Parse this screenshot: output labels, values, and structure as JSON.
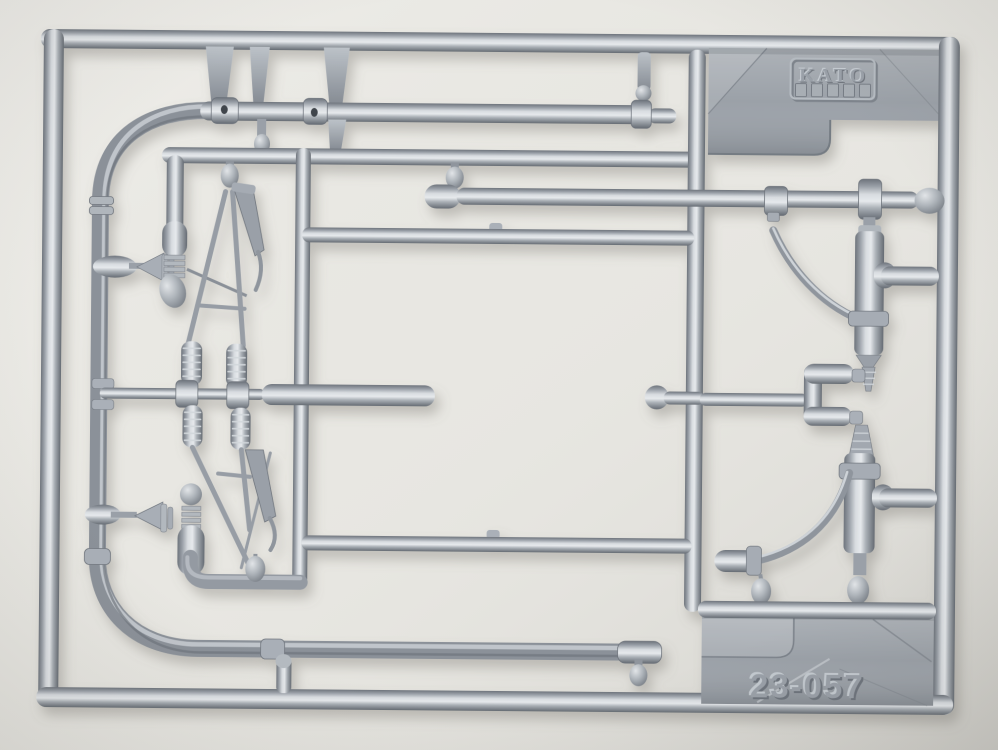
{
  "scene": {
    "type": "photograph",
    "subject": "Silver-gray injection-molded plastic model kit parts sprue (runner) photographed flat on a light neutral background",
    "orientation": "landscape"
  },
  "labels": {
    "brand": "KATO",
    "part_number": "23-057"
  },
  "sprue": {
    "brand_embossed": "KATO",
    "part_number_embossed": "23-057",
    "finish": "metallic silver-gray plastic",
    "parts_visible": [
      "outer rectangular runner frame",
      "two long straight pole rods with sleeve fittings",
      "large curved pole running down the left side and along the bottom",
      "inner rectangular runner frame",
      "upper lattice mast assembly with coil springs and insulator finial",
      "lower lattice mast assembly with coil springs and insulator finial",
      "upper curved feeder arm with cylinder fitting",
      "lower curved feeder arm with cylinder fitting and knobs",
      "C-shaped bracket runner",
      "embossed KATO logo plate with five vent slots",
      "embossed part-number plate"
    ]
  },
  "colors": {
    "background": "#e8e7e2",
    "plastic_mid": "#9aa0a8",
    "plastic_highlight": "#dde1e5",
    "plastic_shadow": "#6b7179",
    "plate_gray": "#9ba1a8",
    "emboss_light": "#c4cad0",
    "emboss_dark": "#6d737b"
  }
}
